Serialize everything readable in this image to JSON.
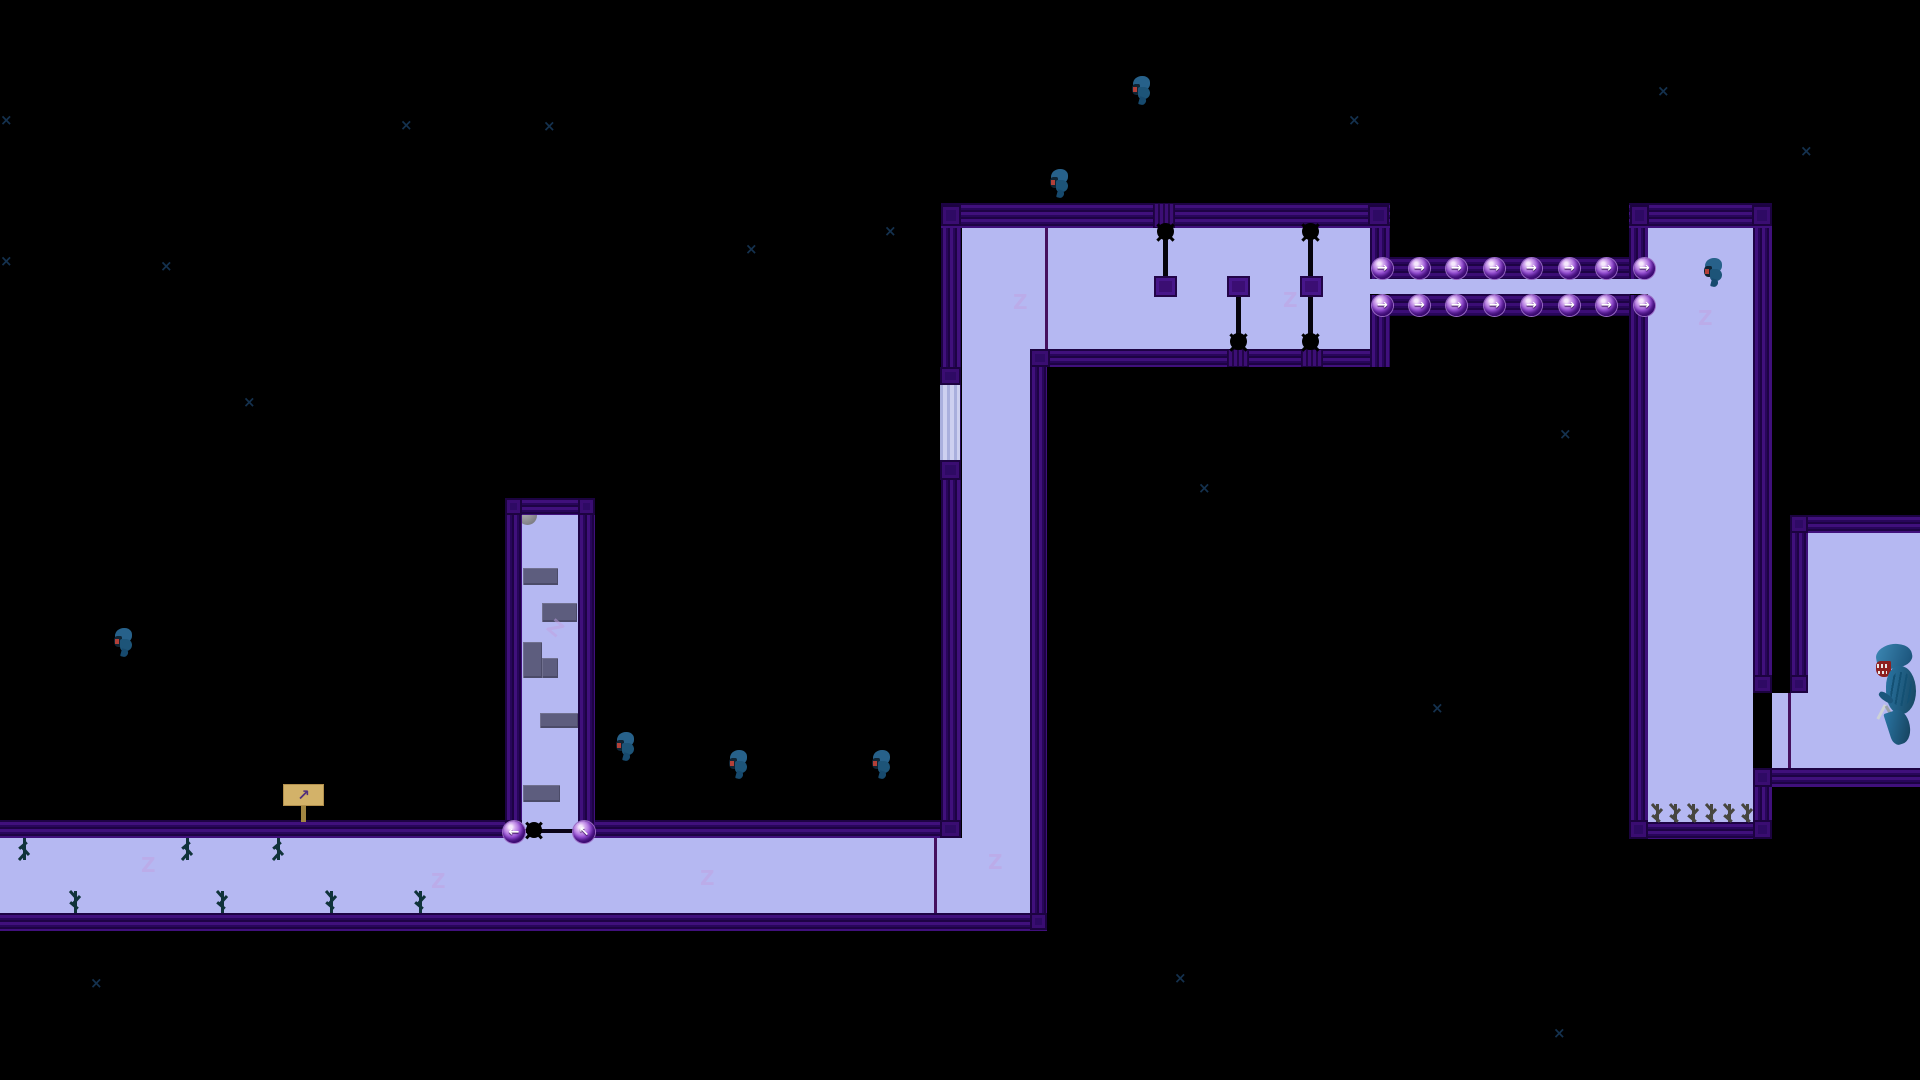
{
  "colors": {
    "background": "#000000",
    "room_fill": "#b5b8f2",
    "wall_dark": "#1d0344",
    "wall_light": "#40107c",
    "corner_block": "#2e0a64",
    "platform_gray": "#5d5d7e",
    "orb_purple": "#9a52d8",
    "orb_arrow": "#ffffff",
    "sign_board": "#d3b269",
    "sign_arrow": "#53307c",
    "tree_teal": "#10333a",
    "twig_gray": "#47463f",
    "creature_blue": "#27618a",
    "creature_red": "#b24038",
    "watermark": "#c2a2e2",
    "sparkle": "#163453",
    "divider": "#45105e",
    "light_wall": "#cdd0f0"
  },
  "icons": {
    "arrow_right": "→",
    "arrow_left": "←",
    "arrow_up_left": "↖",
    "sign_arrow": "↗",
    "watermark_char": "Z",
    "sparkle_char": "×"
  },
  "level": {
    "rects": [
      {
        "k": "room",
        "n": "room-vertical-corridor",
        "x": 962,
        "y": 228,
        "w": 68,
        "h": 685
      },
      {
        "k": "room",
        "n": "room-top-chamber",
        "x": 962,
        "y": 228,
        "w": 408,
        "h": 121
      },
      {
        "k": "room",
        "n": "room-conveyor-strip",
        "x": 1370,
        "y": 279,
        "w": 278,
        "h": 15
      },
      {
        "k": "room",
        "n": "room-tall-right",
        "x": 1648,
        "y": 228,
        "w": 105,
        "h": 594
      },
      {
        "k": "room",
        "n": "room-side-passage",
        "x": 1772,
        "y": 693,
        "w": 36,
        "h": 75
      },
      {
        "k": "room",
        "n": "room-far-right",
        "x": 1808,
        "y": 533,
        "w": 112,
        "h": 235
      },
      {
        "k": "room",
        "n": "room-shaft",
        "x": 522,
        "y": 513,
        "w": 56,
        "h": 325
      },
      {
        "k": "room",
        "n": "room-bottom-corridor",
        "x": 0,
        "y": 838,
        "w": 1030,
        "h": 75
      },
      {
        "k": "lightwall",
        "n": "light-wall-segment",
        "x": 940,
        "y": 385,
        "w": 20,
        "h": 75
      },
      {
        "k": "wallh",
        "n": "wall-top-chamber-ceiling",
        "x": 941,
        "y": 203,
        "w": 449,
        "h": 25
      },
      {
        "k": "wallh",
        "n": "wall-top-chamber-floor",
        "x": 1030,
        "y": 349,
        "w": 360,
        "h": 18
      },
      {
        "k": "wallh",
        "n": "wall-corridor-ceiling-left",
        "x": 0,
        "y": 820,
        "w": 507,
        "h": 18
      },
      {
        "k": "wallh",
        "n": "wall-corridor-ceiling-right",
        "x": 595,
        "y": 820,
        "w": 348,
        "h": 18
      },
      {
        "k": "wallh",
        "n": "wall-corridor-floor",
        "x": 0,
        "y": 913,
        "w": 1047,
        "h": 18
      },
      {
        "k": "wallh",
        "n": "wall-shaft-top",
        "x": 505,
        "y": 498,
        "w": 90,
        "h": 17
      },
      {
        "k": "wallh",
        "n": "wall-tallroom-ceiling",
        "x": 1629,
        "y": 203,
        "w": 143,
        "h": 25
      },
      {
        "k": "wallh",
        "n": "wall-tallroom-floor",
        "x": 1629,
        "y": 822,
        "w": 143,
        "h": 17
      },
      {
        "k": "wallh",
        "n": "wall-farright-ceiling",
        "x": 1790,
        "y": 515,
        "w": 130,
        "h": 18
      },
      {
        "k": "wallh",
        "n": "wall-farright-floor",
        "x": 1755,
        "y": 768,
        "w": 165,
        "h": 19
      },
      {
        "k": "wallv",
        "n": "wall-corridor-left",
        "x": 941,
        "y": 228,
        "w": 20,
        "h": 610
      },
      {
        "k": "wallv",
        "n": "wall-corridor-right",
        "x": 1030,
        "y": 367,
        "w": 17,
        "h": 563
      },
      {
        "k": "wallv",
        "n": "wall-chamber-right-upper",
        "x": 1370,
        "y": 228,
        "w": 20,
        "h": 51
      },
      {
        "k": "wallv",
        "n": "wall-chamber-right-lower",
        "x": 1370,
        "y": 295,
        "w": 20,
        "h": 72
      },
      {
        "k": "wallv",
        "n": "wall-shaft-left",
        "x": 505,
        "y": 515,
        "w": 17,
        "h": 323
      },
      {
        "k": "wallv",
        "n": "wall-shaft-right",
        "x": 578,
        "y": 515,
        "w": 17,
        "h": 315
      },
      {
        "k": "wallv",
        "n": "wall-tallroom-left-upper",
        "x": 1629,
        "y": 228,
        "w": 19,
        "h": 51
      },
      {
        "k": "wallv",
        "n": "wall-tallroom-left-lower",
        "x": 1629,
        "y": 295,
        "w": 19,
        "h": 527
      },
      {
        "k": "wallv",
        "n": "wall-tallroom-right-upper",
        "x": 1753,
        "y": 228,
        "w": 19,
        "h": 465
      },
      {
        "k": "wallv",
        "n": "wall-tallroom-right-lower",
        "x": 1753,
        "y": 787,
        "w": 19,
        "h": 35
      },
      {
        "k": "wallv",
        "n": "wall-farright-left",
        "x": 1790,
        "y": 533,
        "w": 18,
        "h": 160
      },
      {
        "k": "block",
        "n": "wall-corner-block",
        "x": 941,
        "y": 205,
        "w": 20,
        "h": 21
      },
      {
        "k": "block",
        "n": "wall-corner-block",
        "x": 1368,
        "y": 205,
        "w": 21,
        "h": 21
      },
      {
        "k": "block",
        "n": "wall-corner-block",
        "x": 1630,
        "y": 205,
        "w": 19,
        "h": 21
      },
      {
        "k": "block",
        "n": "wall-corner-block",
        "x": 1752,
        "y": 205,
        "w": 20,
        "h": 21
      },
      {
        "k": "block",
        "n": "wall-corner-block",
        "x": 1753,
        "y": 675,
        "w": 19,
        "h": 18
      },
      {
        "k": "block",
        "n": "wall-corner-block",
        "x": 1753,
        "y": 768,
        "w": 19,
        "h": 19
      },
      {
        "k": "block",
        "n": "wall-corner-block",
        "x": 1790,
        "y": 515,
        "w": 18,
        "h": 18
      },
      {
        "k": "block",
        "n": "wall-corner-block",
        "x": 1790,
        "y": 675,
        "w": 18,
        "h": 18
      },
      {
        "k": "block",
        "n": "wall-corner-block",
        "x": 1629,
        "y": 820,
        "w": 19,
        "h": 19
      },
      {
        "k": "block",
        "n": "wall-corner-block",
        "x": 1753,
        "y": 820,
        "w": 19,
        "h": 19
      },
      {
        "k": "block",
        "n": "wall-corner-block",
        "x": 940,
        "y": 367,
        "w": 21,
        "h": 18
      },
      {
        "k": "block",
        "n": "wall-corner-block",
        "x": 940,
        "y": 460,
        "w": 21,
        "h": 20
      },
      {
        "k": "block",
        "n": "wall-corner-block",
        "x": 940,
        "y": 820,
        "w": 21,
        "h": 18
      },
      {
        "k": "block",
        "n": "wall-corner-block",
        "x": 1030,
        "y": 913,
        "w": 17,
        "h": 17
      },
      {
        "k": "block",
        "n": "wall-corner-block",
        "x": 1030,
        "y": 349,
        "w": 20,
        "h": 18
      },
      {
        "k": "block",
        "n": "wall-corner-block",
        "x": 505,
        "y": 498,
        "w": 17,
        "h": 17
      },
      {
        "k": "block",
        "n": "wall-corner-block",
        "x": 578,
        "y": 498,
        "w": 17,
        "h": 17
      },
      {
        "k": "block",
        "n": "wall-corner-block",
        "x": 505,
        "y": 820,
        "w": 17,
        "h": 18
      },
      {
        "k": "ablock",
        "n": "wall-anchor-block",
        "x": 1153,
        "y": 203,
        "w": 22,
        "h": 25
      },
      {
        "k": "ablock",
        "n": "wall-anchor-block",
        "x": 1227,
        "y": 349,
        "w": 22,
        "h": 18
      },
      {
        "k": "ablock",
        "n": "wall-anchor-block",
        "x": 1301,
        "y": 349,
        "w": 22,
        "h": 18
      },
      {
        "k": "track",
        "n": "conveyor-track",
        "x": 1390,
        "y": 257,
        "w": 240,
        "h": 22
      },
      {
        "k": "track",
        "n": "conveyor-track",
        "x": 1390,
        "y": 294,
        "w": 240,
        "h": 22
      },
      {
        "k": "plat",
        "n": "stone-platform",
        "x": 523,
        "y": 568,
        "w": 35,
        "h": 17
      },
      {
        "k": "plat",
        "n": "stone-platform",
        "x": 542,
        "y": 603,
        "w": 35,
        "h": 19
      },
      {
        "k": "plat",
        "n": "stone-platform",
        "x": 523,
        "y": 642,
        "w": 19,
        "h": 36
      },
      {
        "k": "plat",
        "n": "stone-platform",
        "x": 542,
        "y": 658,
        "w": 16,
        "h": 20
      },
      {
        "k": "plat",
        "n": "stone-platform",
        "x": 540,
        "y": 713,
        "w": 38,
        "h": 15
      },
      {
        "k": "plat",
        "n": "stone-platform",
        "x": 523,
        "y": 785,
        "w": 37,
        "h": 17
      },
      {
        "k": "gball",
        "n": "boulder",
        "x": 518,
        "y": 506,
        "w": 19,
        "h": 19
      },
      {
        "k": "line",
        "n": "screen-divider-line",
        "x": 1045,
        "y": 228,
        "w": 3,
        "h": 121
      },
      {
        "k": "line",
        "n": "screen-divider-line",
        "x": 934,
        "y": 838,
        "w": 3,
        "h": 75
      },
      {
        "k": "line",
        "n": "screen-divider-line",
        "x": 1788,
        "y": 693,
        "w": 3,
        "h": 75
      },
      {
        "k": "rod",
        "n": "piston-rod",
        "x": 1163,
        "y": 236,
        "w": 5,
        "h": 45
      },
      {
        "k": "rod",
        "n": "piston-rod",
        "x": 1236,
        "y": 294,
        "w": 5,
        "h": 44
      },
      {
        "k": "rod",
        "n": "piston-rod",
        "x": 1308,
        "y": 238,
        "w": 5,
        "h": 100
      },
      {
        "k": "psq",
        "n": "piston-block",
        "x": 1154,
        "y": 276,
        "w": 23,
        "h": 21
      },
      {
        "k": "psq",
        "n": "piston-block",
        "x": 1227,
        "y": 276,
        "w": 23,
        "h": 21
      },
      {
        "k": "psq",
        "n": "piston-block",
        "x": 1300,
        "y": 276,
        "w": 23,
        "h": 21
      },
      {
        "k": "wire",
        "n": "gate-wire",
        "x": 515,
        "y": 829,
        "w": 70,
        "h": 4
      }
    ],
    "spike_balls": [
      {
        "x": 1157,
        "y": 223,
        "s": 17
      },
      {
        "x": 1230,
        "y": 333,
        "s": 17
      },
      {
        "x": 1302,
        "y": 223,
        "s": 17
      },
      {
        "x": 1302,
        "y": 333,
        "s": 17
      },
      {
        "x": 526,
        "y": 822,
        "s": 16
      }
    ],
    "orbs": [
      {
        "x": 1372,
        "y": 258,
        "s": 21,
        "a": "arrow_right"
      },
      {
        "x": 1409,
        "y": 258,
        "s": 21,
        "a": "arrow_right"
      },
      {
        "x": 1446,
        "y": 258,
        "s": 21,
        "a": "arrow_right"
      },
      {
        "x": 1484,
        "y": 258,
        "s": 21,
        "a": "arrow_right"
      },
      {
        "x": 1521,
        "y": 258,
        "s": 21,
        "a": "arrow_right"
      },
      {
        "x": 1559,
        "y": 258,
        "s": 21,
        "a": "arrow_right"
      },
      {
        "x": 1596,
        "y": 258,
        "s": 21,
        "a": "arrow_right"
      },
      {
        "x": 1634,
        "y": 258,
        "s": 21,
        "a": "arrow_right"
      },
      {
        "x": 1372,
        "y": 295,
        "s": 21,
        "a": "arrow_right"
      },
      {
        "x": 1409,
        "y": 295,
        "s": 21,
        "a": "arrow_right"
      },
      {
        "x": 1446,
        "y": 295,
        "s": 21,
        "a": "arrow_right"
      },
      {
        "x": 1484,
        "y": 295,
        "s": 21,
        "a": "arrow_right"
      },
      {
        "x": 1521,
        "y": 295,
        "s": 21,
        "a": "arrow_right"
      },
      {
        "x": 1559,
        "y": 295,
        "s": 21,
        "a": "arrow_right"
      },
      {
        "x": 1596,
        "y": 295,
        "s": 21,
        "a": "arrow_right"
      },
      {
        "x": 1634,
        "y": 295,
        "s": 21,
        "a": "arrow_right"
      },
      {
        "x": 503,
        "y": 821,
        "s": 22,
        "a": "arrow_left"
      },
      {
        "x": 573,
        "y": 821,
        "s": 22,
        "a": "arrow_up_left"
      }
    ],
    "sign": {
      "board": {
        "x": 283,
        "y": 784,
        "w": 41,
        "h": 22
      },
      "post": {
        "x": 301,
        "y": 806,
        "w": 5,
        "h": 16
      }
    },
    "trees": [
      {
        "x": 17,
        "y": 838,
        "h": 22,
        "flip": true
      },
      {
        "x": 180,
        "y": 838,
        "h": 22,
        "flip": true
      },
      {
        "x": 271,
        "y": 838,
        "h": 22,
        "flip": true
      },
      {
        "x": 68,
        "y": 891,
        "h": 22,
        "flip": false
      },
      {
        "x": 215,
        "y": 891,
        "h": 22,
        "flip": false
      },
      {
        "x": 324,
        "y": 891,
        "h": 22,
        "flip": false
      },
      {
        "x": 413,
        "y": 891,
        "h": 22,
        "flip": false
      }
    ],
    "twigs": [
      {
        "x": 1650,
        "y": 804,
        "h": 18
      },
      {
        "x": 1668,
        "y": 804,
        "h": 18
      },
      {
        "x": 1686,
        "y": 804,
        "h": 18
      },
      {
        "x": 1704,
        "y": 804,
        "h": 18
      },
      {
        "x": 1722,
        "y": 804,
        "h": 18
      },
      {
        "x": 1740,
        "y": 804,
        "h": 18
      }
    ],
    "creatures": [
      {
        "x": 1130,
        "y": 75
      },
      {
        "x": 1048,
        "y": 168
      },
      {
        "x": 112,
        "y": 627
      },
      {
        "x": 614,
        "y": 731
      },
      {
        "x": 727,
        "y": 749
      },
      {
        "x": 870,
        "y": 749
      },
      {
        "x": 1702,
        "y": 257
      }
    ],
    "alien": {
      "x": 1876,
      "y": 642,
      "w": 44,
      "h": 108
    },
    "watermarks": [
      {
        "x": 1013,
        "y": 292,
        "rot": 0
      },
      {
        "x": 1283,
        "y": 290,
        "rot": 0
      },
      {
        "x": 1698,
        "y": 308,
        "rot": 0
      },
      {
        "x": 988,
        "y": 852,
        "rot": 0
      },
      {
        "x": 141,
        "y": 855,
        "rot": 0
      },
      {
        "x": 431,
        "y": 871,
        "rot": 0
      },
      {
        "x": 700,
        "y": 868,
        "rot": 0
      },
      {
        "x": 548,
        "y": 618,
        "rot": 40
      }
    ],
    "sparkles": [
      {
        "x": 884,
        "y": 224
      },
      {
        "x": 0,
        "y": 113
      },
      {
        "x": 400,
        "y": 118
      },
      {
        "x": 543,
        "y": 119
      },
      {
        "x": 745,
        "y": 242
      },
      {
        "x": 160,
        "y": 259
      },
      {
        "x": 0,
        "y": 254
      },
      {
        "x": 1348,
        "y": 113
      },
      {
        "x": 1657,
        "y": 84
      },
      {
        "x": 1800,
        "y": 144
      },
      {
        "x": 243,
        "y": 395
      },
      {
        "x": 1198,
        "y": 481
      },
      {
        "x": 1559,
        "y": 427
      },
      {
        "x": 1431,
        "y": 701
      },
      {
        "x": 90,
        "y": 976
      },
      {
        "x": 1174,
        "y": 971
      },
      {
        "x": 1553,
        "y": 1026
      }
    ]
  }
}
